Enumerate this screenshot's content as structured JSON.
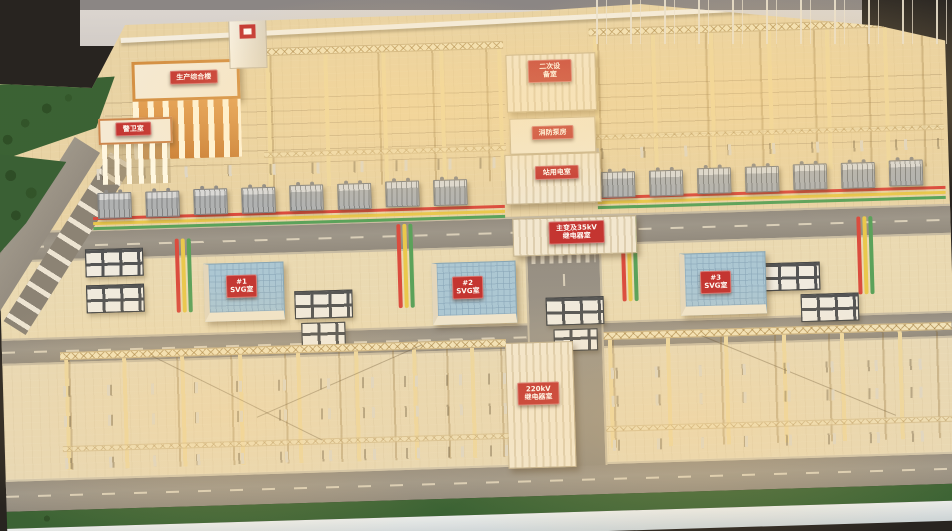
{
  "signs": {
    "admin_building": "生产综合楼",
    "guard_house": "警卫室",
    "secondary_equipment": "二次设\n备室",
    "fire_pump": "消防泵房",
    "station_power": "站用电室",
    "main_transformer_relay": "主变及35kV\n继电器室",
    "svg_room_1": "#1\nSVG室",
    "svg_room_2": "#2\nSVG室",
    "svg_room_3": "#3\nSVG室",
    "relay_room_220kv": "220kV\n继电器室"
  },
  "colors": {
    "sign_red": "#bf2a2c",
    "svg_roof_blue": "#a6c7da",
    "grass_green": "#2c5b2f",
    "ground_tan": "#e7d4a8",
    "busbar_red": "#d8433a",
    "busbar_yellow": "#e8c84a",
    "busbar_green": "#4f9f58",
    "building_orange": "#d08a3e"
  }
}
